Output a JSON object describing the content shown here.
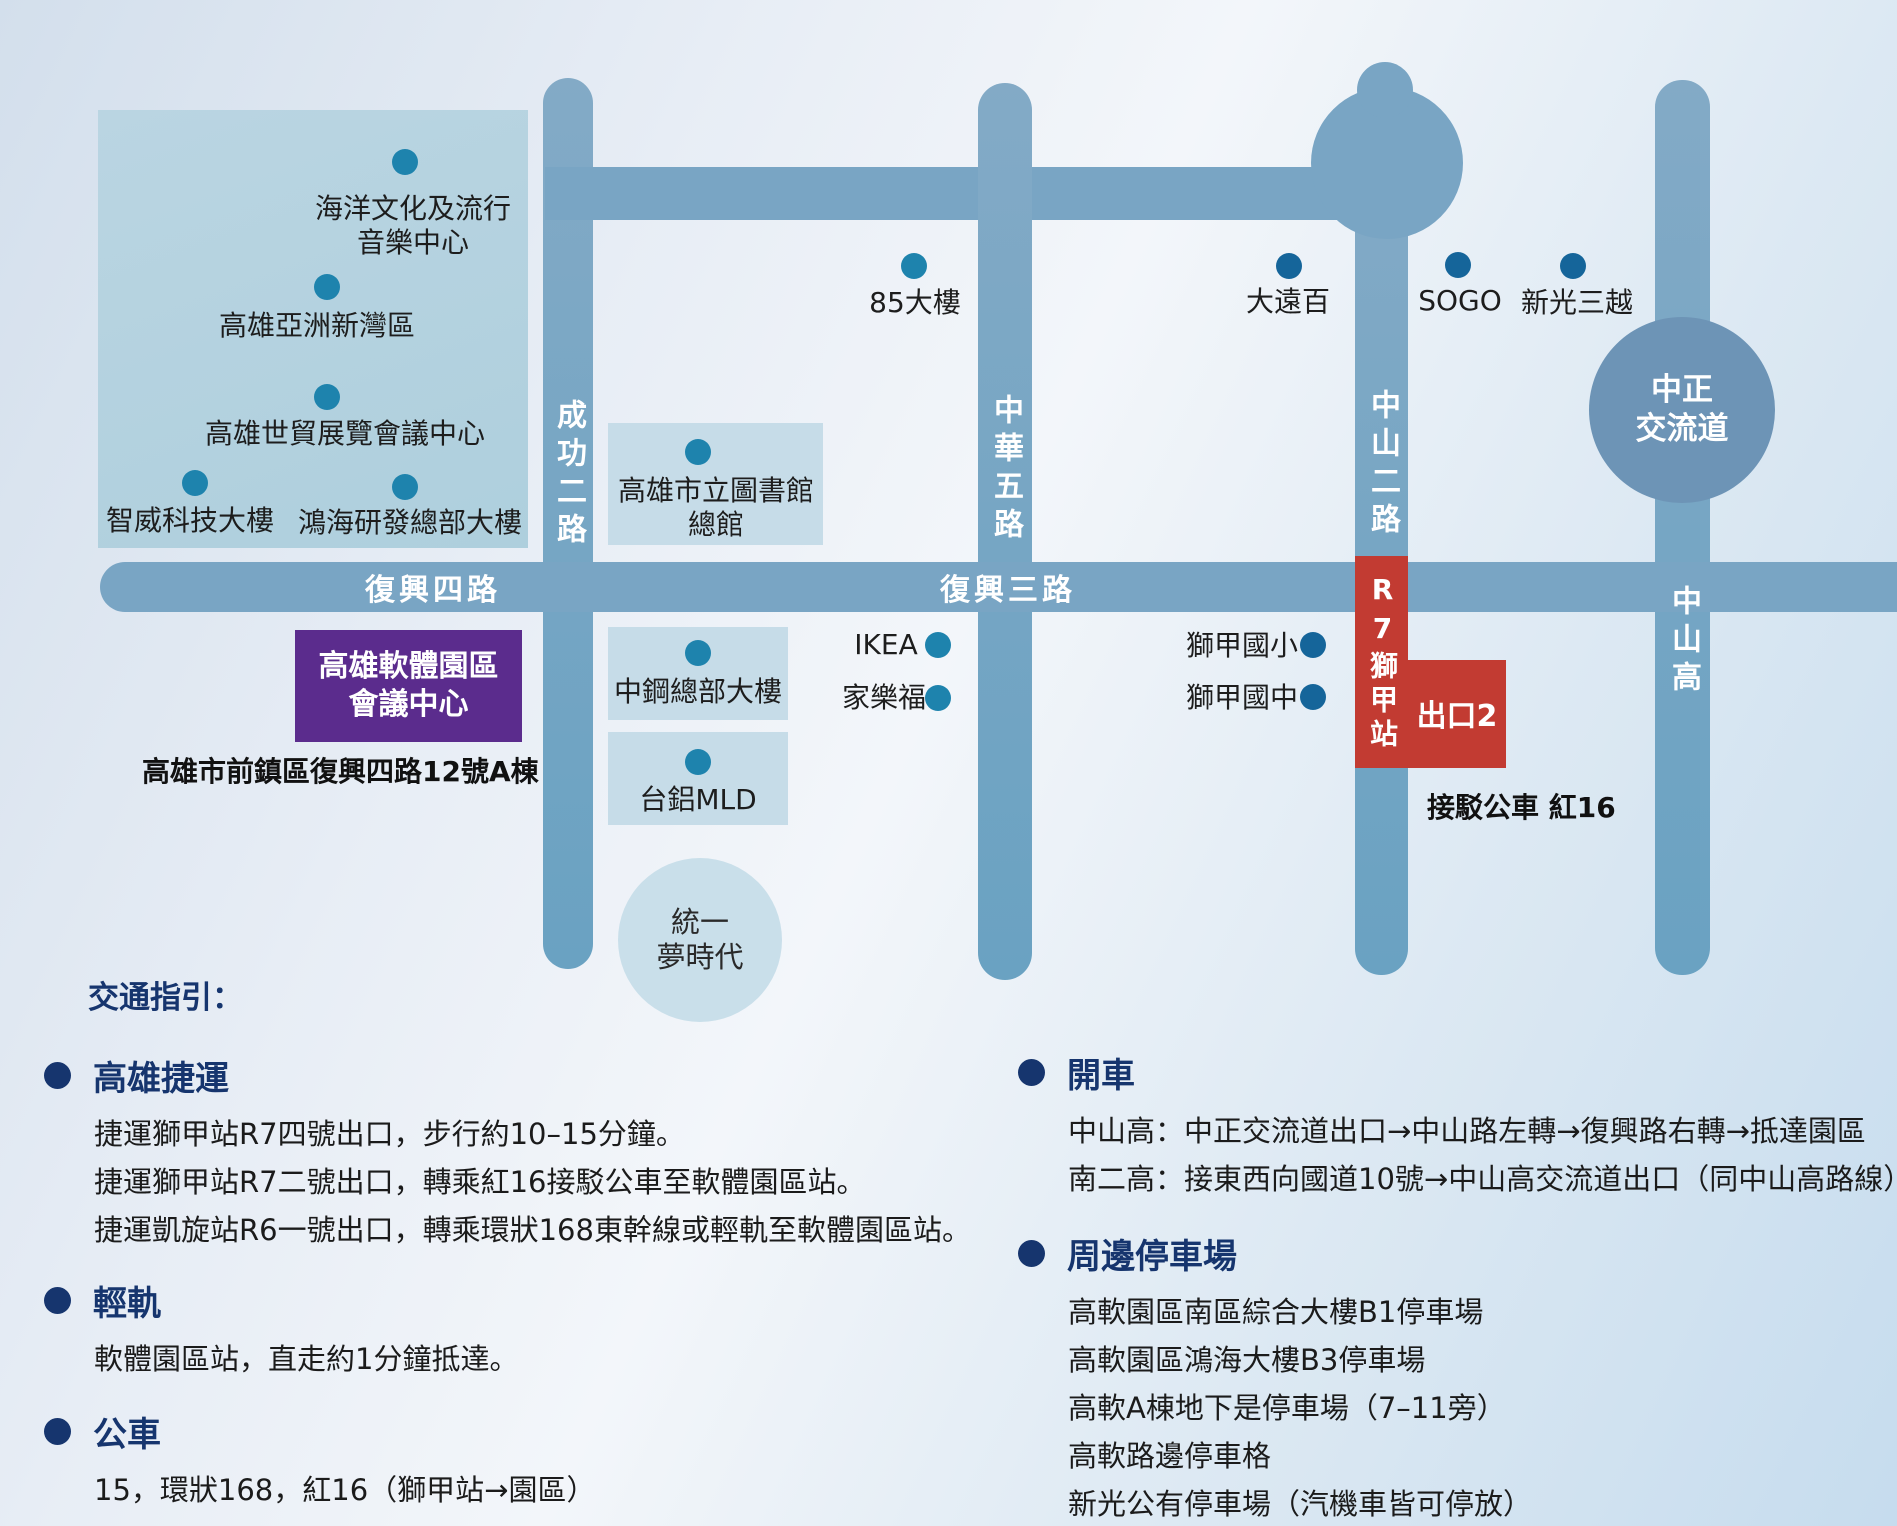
{
  "map": {
    "roads": {
      "chenggong": "成功二路",
      "zhonghua": "中華五路",
      "zhongshan2": "中山二路",
      "zhongshan_hwy": "中山高",
      "fuxing4": "復興四路",
      "fuxing3": "復興三路"
    },
    "interchange": {
      "line1": "中正",
      "line2": "交流道"
    },
    "district": {
      "music_center_1": "海洋文化及流行",
      "music_center_2": "音樂中心",
      "asia_bay": "高雄亞洲新灣區",
      "expo": "高雄世貿展覽會議中心",
      "zhiwei": "智威科技大樓",
      "foxconn": "鴻海研發總部大樓"
    },
    "landmarks": {
      "tower85": "85大樓",
      "dayuanbai": "大遠百",
      "sogo": "SOGO",
      "shinkong": "新光三越",
      "library_1": "高雄市立圖書館",
      "library_2": "總館",
      "csc": "中鋼總部大樓",
      "mld": "台鋁MLD",
      "dream_1": "統一",
      "dream_2": "夢時代",
      "ikea": "IKEA",
      "carrefour": "家樂福",
      "shijia_elementary": "獅甲國小",
      "shijia_junior": "獅甲國中"
    },
    "venue": {
      "name_1": "高雄軟體園區",
      "name_2": "會議中心",
      "address": "高雄市前鎮區復興四路12號A棟"
    },
    "station": {
      "name": "R7獅甲站",
      "exit": "出口2",
      "shuttle": "接駁公車 紅16"
    }
  },
  "directions": {
    "title": "交通指引：",
    "left": [
      {
        "title": "高雄捷運",
        "lines": [
          "捷運獅甲站R7四號出口，步行約10–15分鐘。",
          "捷運獅甲站R7二號出口，轉乘紅16接駁公車至軟體園區站。",
          "捷運凱旋站R6一號出口，轉乘環狀168東幹線或輕軌至軟體園區站。"
        ]
      },
      {
        "title": "輕軌",
        "lines": [
          "軟體園區站，直走約1分鐘抵達。"
        ]
      },
      {
        "title": "公車",
        "lines": [
          "15，環狀168，紅16（獅甲站→園區）"
        ]
      }
    ],
    "right": [
      {
        "title": "開車",
        "lines": [
          "中山高：中正交流道出口→中山路左轉→復興路右轉→抵達園區",
          "南二高：接東西向國道10號→中山高交流道出口（同中山高路線）"
        ]
      },
      {
        "title": "周邊停車場",
        "lines": [
          "高軟園區南區綜合大樓B1停車場",
          "高軟園區鴻海大樓B3停車場",
          "高軟A棟地下是停車場（7–11旁）",
          "高軟路邊停車格",
          "新光公有停車場（汽機車皆可停放）"
        ]
      }
    ]
  },
  "colors": {
    "road": "#79a5c4",
    "interchange_circle": "#6d94b6",
    "district_box": "#b5d2e0",
    "landmark_box": "#c6dce8",
    "venue_purple": "#5b2c8d",
    "station_red": "#c23b32",
    "heading_navy": "#16356e",
    "dot_teal": "#1e83ad",
    "dot_navy": "#15659a"
  }
}
